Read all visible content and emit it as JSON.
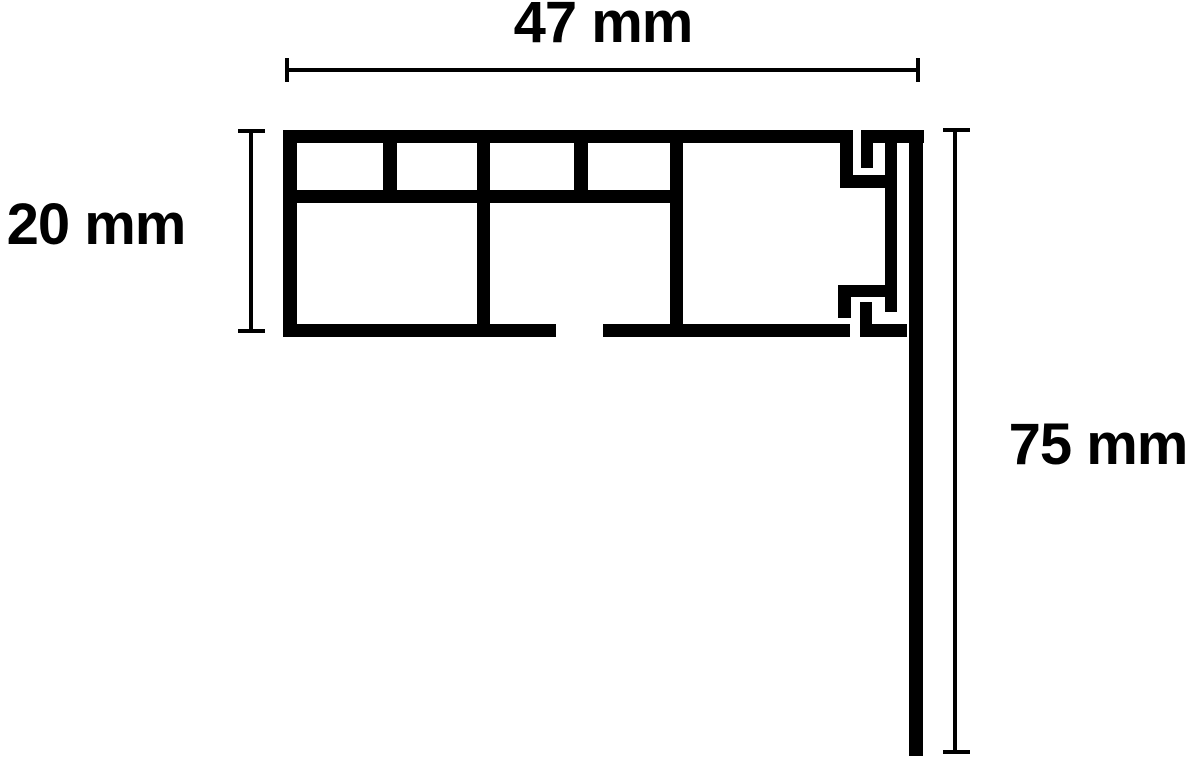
{
  "diagram": {
    "type": "profile-cross-section",
    "labels": {
      "width": "47 mm",
      "height": "20 mm",
      "drop": "75 mm"
    },
    "dimensions_mm": {
      "width": 47,
      "height": 20,
      "drop": 75
    },
    "line_color": "#000000",
    "background_color": "#ffffff"
  }
}
